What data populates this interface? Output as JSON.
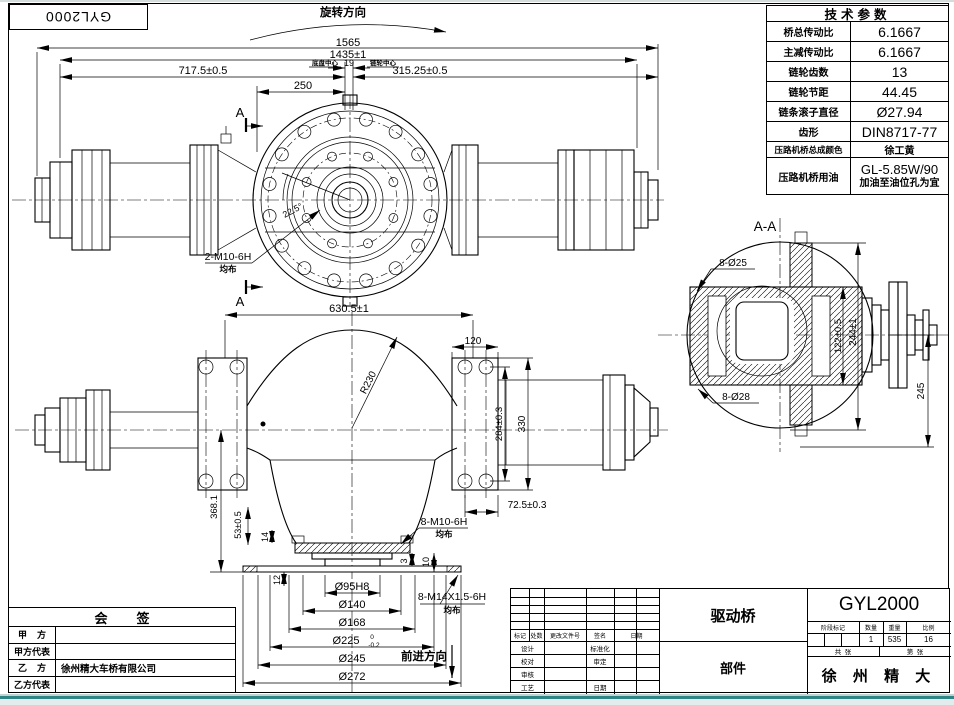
{
  "window": {
    "teal_edge": "#2f8585",
    "paper": "#ffffff",
    "ink": "#000000"
  },
  "top_left_label": "GYL2000",
  "front_view": {
    "rotation_dir": "旋转方向",
    "d1565": "1565",
    "d1435": "1435±1",
    "d717": "717.5±0.5",
    "d315": "315.25±0.5",
    "d250": "250",
    "d19": "19",
    "base_center_note": "底盘中心",
    "sprocket_center_note": "链轮中心",
    "section_mark": "A",
    "bolt_callout": "2-M10-6H",
    "bolt_note": "均布",
    "angle": "22.5°"
  },
  "section_view": {
    "title": "A-A",
    "holes_top": "8-Ø25",
    "holes_bottom": "8-Ø28",
    "d122": "122±0.5",
    "d244": "244±1",
    "d245": "245"
  },
  "plan_view": {
    "d630": "630.5±1",
    "d120": "120",
    "r230": "R230",
    "d284": "284±0.3",
    "d330": "330",
    "d368": "368.1",
    "d53": "53±0.5",
    "d14": "14",
    "d12": "12",
    "d3": "3",
    "d10": "10",
    "d72": "72.5±0.3",
    "m10_callout": "8-M10-6H",
    "m10_note": "均布",
    "m14_callout": "8-M14X1.5-6H",
    "m14_note": "均布",
    "d95": "Ø95H8",
    "d140": "Ø140",
    "d168": "Ø168",
    "d225": "Ø225",
    "d225_tol_top": "0",
    "d225_tol_bot": "-0.2",
    "d245": "Ø245",
    "d272": "Ø272",
    "forward": "前进方向"
  },
  "tech_table": {
    "title": "技术参数",
    "rows": [
      {
        "label": "桥总传动比",
        "value": "6.1667"
      },
      {
        "label": "主减传动比",
        "value": "6.1667"
      },
      {
        "label": "链轮齿数",
        "value": "13"
      },
      {
        "label": "链轮节距",
        "value": "44.45"
      },
      {
        "label": "链条滚子直径",
        "value": "Ø27.94"
      },
      {
        "label": "齿形",
        "value": "DIN8717-77"
      },
      {
        "label": "压路机桥总成颜色",
        "value": "徐工黄"
      },
      {
        "label": "压路机桥用油",
        "value": "GL-5.85W/90",
        "value2": "加油至油位孔为宜"
      }
    ]
  },
  "countersign": {
    "title": "会        签",
    "rows": [
      {
        "label": "甲    方",
        "value": ""
      },
      {
        "label": "甲方代表",
        "value": ""
      },
      {
        "label": "乙    方",
        "value": "徐州精大车桥有限公司"
      },
      {
        "label": "乙方代表",
        "value": ""
      }
    ]
  },
  "title_block": {
    "part_name": "驱动桥",
    "part_type": "部件",
    "drawing_no": "GYL2000",
    "company": "徐 州 精 大",
    "rev_headers": [
      "标记",
      "处数",
      "更改文件号",
      "签名",
      "日期"
    ],
    "sign_rows": [
      {
        "left": "设计",
        "right": "标准化"
      },
      {
        "left": "校对",
        "right": "审定"
      },
      {
        "left": "审核",
        "right": ""
      },
      {
        "left": "工艺",
        "right": "日期"
      }
    ],
    "prop_headers": [
      "阶段标记",
      "数量",
      "重量",
      "比例"
    ],
    "qty": "1",
    "weight": "535",
    "scale": "16",
    "sheet_total": "共  张",
    "sheet_no": "第  张"
  }
}
